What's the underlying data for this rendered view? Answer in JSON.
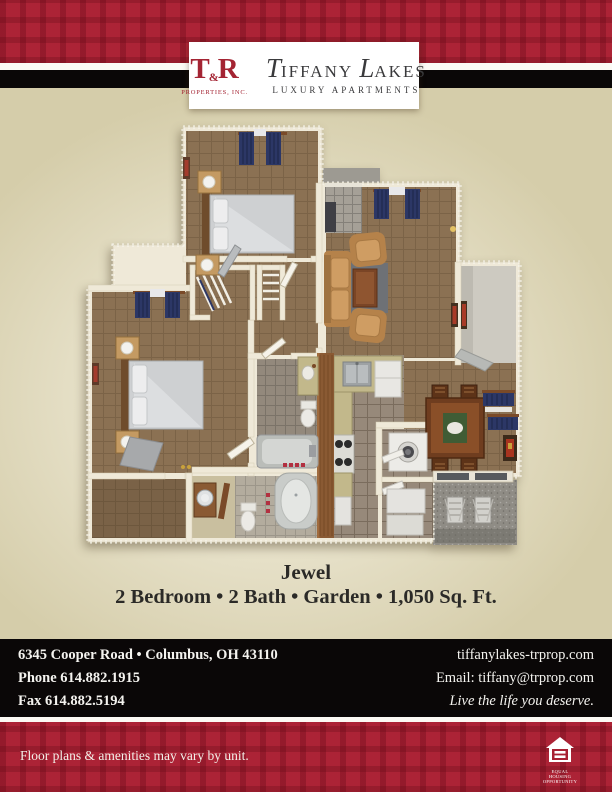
{
  "palette": {
    "plaid-red": "#a82133",
    "band-black": "#0a0707",
    "page-tan": "#d5cdaa",
    "page-light": "#f4f1e6",
    "logo-red": "#a42433",
    "logo-gray": "#3a3a3c",
    "text-dark": "#2b2a27",
    "footer-text": "#f4f3ef",
    "wall-cream": "#efe9d8",
    "carpet-brown": "#8b7153",
    "curtain-navy": "#2c3766"
  },
  "logo": {
    "tr_t": "T",
    "tr_amp": "&",
    "tr_r": "R",
    "tr_sub": "PROPERTIES, INC.",
    "brand_t": "T",
    "brand_rest1": "IFFANY",
    "brand_l": "L",
    "brand_rest2": "AKES",
    "brand_sub": "LUXURY APARTMENTS"
  },
  "plan": {
    "name": "Jewel",
    "details": "2 Bedroom • 2 Bath • Garden • 1,050 Sq. Ft."
  },
  "footer": {
    "address": "6345 Cooper Road • Columbus, OH 43110",
    "phone": "Phone 614.882.1915",
    "fax": "Fax 614.882.5194",
    "website": "tiffanylakes-trprop.com",
    "email": "Email: tiffany@trprop.com",
    "tagline": "Live the life you deserve."
  },
  "disclaimer": "Floor plans & amenities may vary by unit.",
  "equal_housing": "EQUAL HOUSING OPPORTUNITY"
}
